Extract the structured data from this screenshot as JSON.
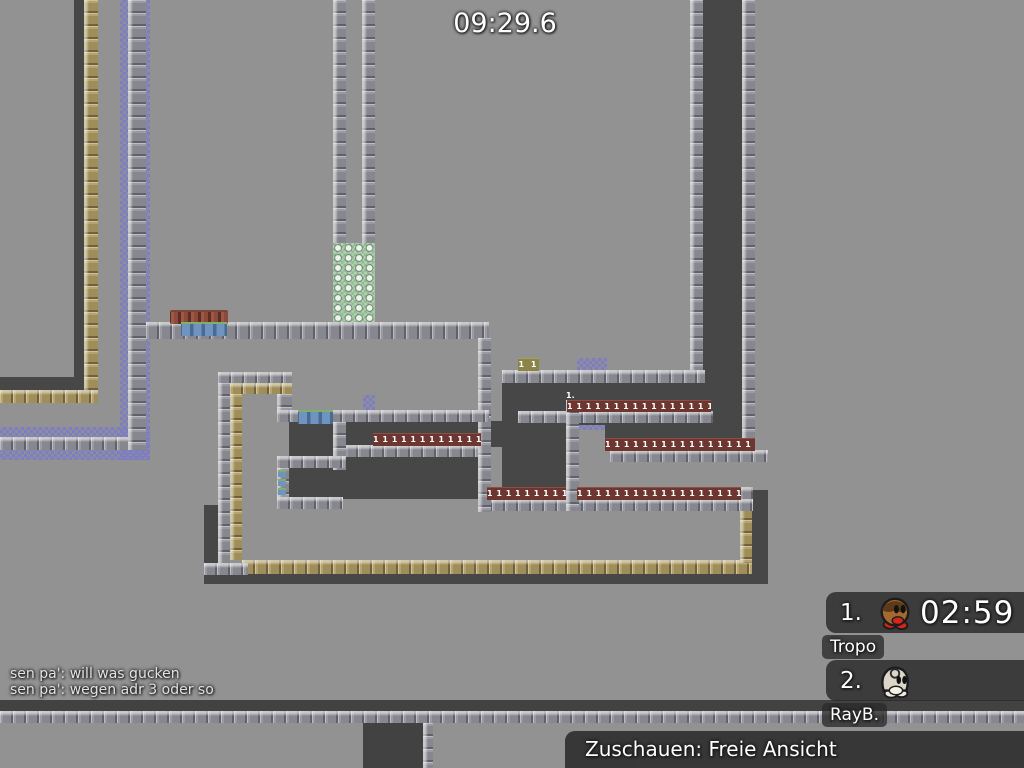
{
  "hud": {
    "timer": "09:29.6"
  },
  "chat": {
    "lines": [
      "sen pa': will was gucken",
      "sen pa': wegen adr 3 oder so"
    ]
  },
  "scoreboard": {
    "entries": [
      {
        "rank": "1.",
        "time": "02:59",
        "name": "Tropo",
        "skin": "brown-tee"
      },
      {
        "rank": "2.",
        "time": "",
        "name": "RayB.",
        "skin": "white-tee"
      }
    ]
  },
  "spectate": {
    "label": "Zuschauen: Freie Ansicht"
  },
  "map": {
    "switch_number_strips": {
      "r1": "1 1 1 1 1 1 1 1 1 1 1 1 1 1 1 1 1 1",
      "r2": "1 1 1 1 1 1 1 1 1 1 1 1 1 1 1 1 1 1 1",
      "r5": "1 1 1 1 1 1 1 1 1 1 1 1 1 1",
      "r3": "1 1 1 1 1 1 1 1 1 1",
      "r4": "1 1 1 1 1 1 1 1 1 1 1 1 1 1 1 1 1 1 1 1 1",
      "olive": "1 1",
      "lone": "1."
    },
    "colors": {
      "background": "#929292",
      "wall_dark": "#474747",
      "tile_gray": "#9a9aa2",
      "khaki": "#b4a271",
      "checker_purple": "#7d7dc4",
      "switch_red": "#6e3630",
      "pickup_green": "#93b893"
    }
  }
}
